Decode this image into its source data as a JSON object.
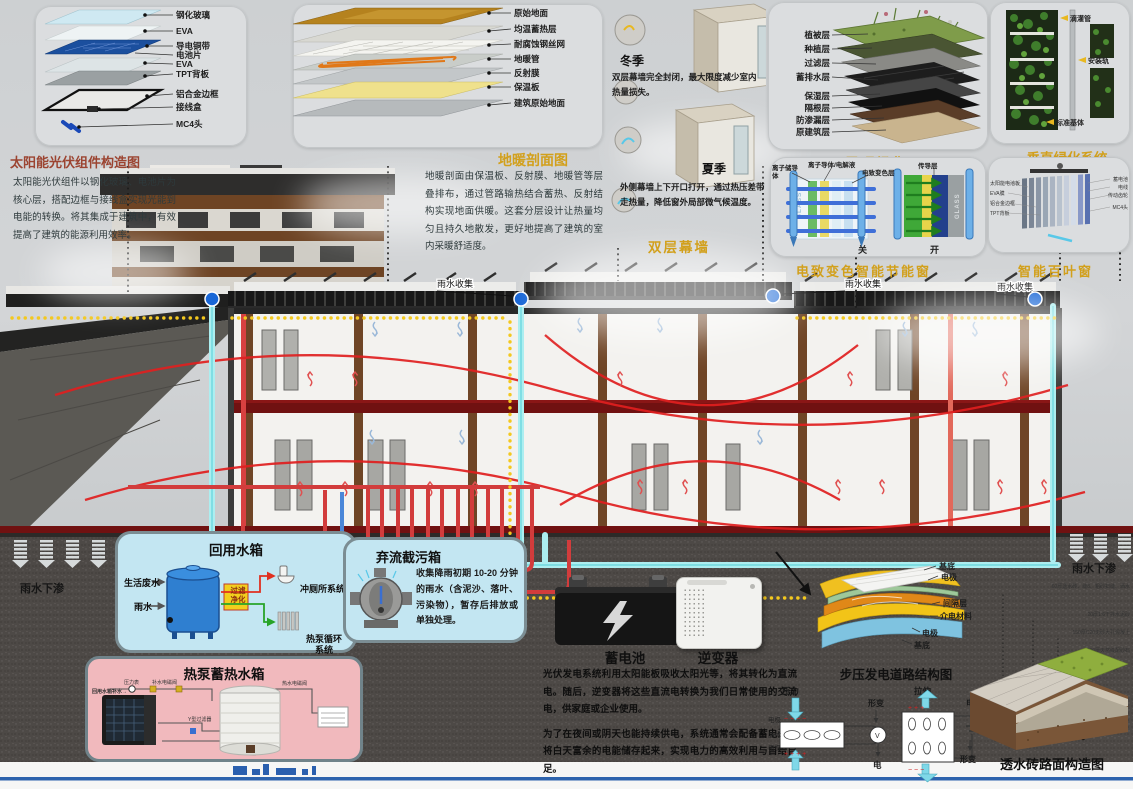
{
  "pv": {
    "title": "太阳能光伏组件构造图",
    "layers": [
      "钢化玻璃",
      "EVA",
      "导电铜带",
      "电池片",
      "EVA",
      "TPT背板",
      "铝合金边框",
      "接线盒",
      "MC4头"
    ],
    "desc": "太阳能光伏组件以钢化玻璃、电池片为核心层，搭配边框与接线盒实现光能到电能的转换。将其集成于建筑中，有效提高了建筑的能源利用效率。"
  },
  "heating": {
    "title": "地暖剖面图",
    "layers": [
      "原始地面",
      "均温蓄热层",
      "耐腐蚀钢丝网",
      "地暖管",
      "反射膜",
      "保温板",
      "建筑原始地面"
    ],
    "desc": "地暖剖面由保温板、反射膜、地暖管等层叠排布，通过管路输热结合蓄热、反射结构实现地面供暖。这套分层设计让热量均匀且持久地散发，更好地提高了建筑的室内采暖舒适度。"
  },
  "curtain": {
    "title": "双层幕墙",
    "winter_label": "冬季",
    "winter_text": "双层幕墙完全封闭，最大限度减少室内热量损失。",
    "summer_label": "夏季",
    "summer_text": "外侧幕墙上下开口打开，通过热压差带走热量，降低窗外局部微气候温度。"
  },
  "roof_green": {
    "title": "屋顶绿化",
    "layers": [
      "植被层",
      "种植层",
      "过滤层",
      "蓄排水层",
      "保湿层",
      "隔根层",
      "防渗漏层",
      "原建筑层"
    ]
  },
  "vertical_green": {
    "title": "垂直绿化系统",
    "labels": [
      "滴灌管",
      "安装轨",
      "标准基体"
    ]
  },
  "ec_window": {
    "title": "电致变色智能节能窗",
    "labels": [
      "离子储导体",
      "离子导体/电解液",
      "电致变色层",
      "传导层"
    ],
    "glass": "GLASS",
    "state_closed": "关",
    "state_open": "开"
  },
  "blinds": {
    "title": "智能百叶窗",
    "labels": [
      "太阳能电池板",
      "EVA膜",
      "铝合金边框",
      "TPT背板",
      "蓄电池",
      "电线",
      "传动齿轮",
      "MC4头"
    ]
  },
  "scene": {
    "rain_collect": "雨水收集",
    "rain_infiltrate": "雨水下渗"
  },
  "reuse_tank": {
    "title": "回用水箱",
    "input1": "生活废水",
    "input2": "雨水",
    "filter1": "过滤",
    "filter2": "净化",
    "out1": "冲厕所系统",
    "out2": "热泵循环系统"
  },
  "diversion": {
    "title": "弃流截污箱",
    "desc": "收集降雨初期 10-20 分钟的雨水（含泥沙、落叶、污染物），暂存后排放或单独处理。"
  },
  "heatpump": {
    "title": "热泵蓄热水箱",
    "labels": [
      "压力表",
      "补水电磁阀",
      "回用水箱补水→",
      "Y型过滤器",
      "热水电磁阀"
    ]
  },
  "energy": {
    "battery": "蓄电池",
    "inverter": "逆变器",
    "para1": "光伏发电系统利用太阳能板吸收太阳光等，将其转化为直流电。随后，逆变器将这些直流电转换为我们日常使用的交流电，供家庭或企业使用。",
    "para2": "为了在夜间或阴天也能持续供电，系统通常会配备蓄电池，将白天富余的电能储存起来，实现电力的高效利用与自给自足。"
  },
  "piezo": {
    "title": "步压发电道路结构图",
    "layers": [
      "基底",
      "电极",
      "间隔层",
      "介电材料",
      "电极",
      "基底"
    ],
    "pressure": "压力",
    "electrode_top": "电极",
    "crystal": "晶体",
    "electrode_bottom": "电极",
    "deform": "形变",
    "electricity": "电",
    "stretch": "拉伸",
    "electricity2": "电",
    "deform2": "形变"
  },
  "permeable": {
    "title": "透水砖路面构造图",
    "layers": [
      "60厚透水砖、缝8、粗砂扫缝、洒水",
      "20厚1:6干拌水泥砂",
      "150厚C20无砂大孔混凝土",
      "300厚天然级配砂石",
      "素土夯实"
    ]
  }
}
